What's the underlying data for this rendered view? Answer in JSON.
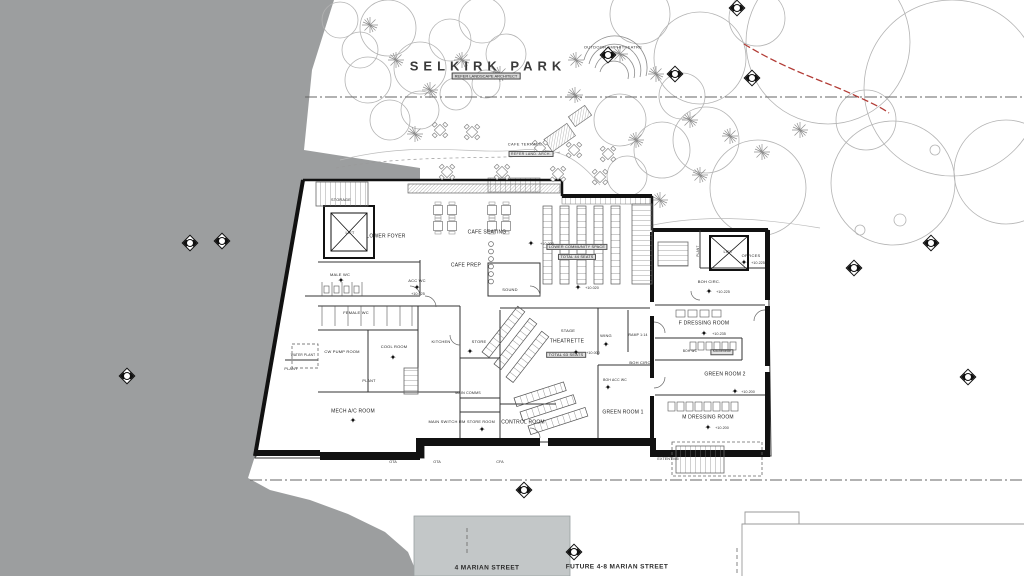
{
  "colors": {
    "terrain": "#9c9e9f",
    "street_block": "#c3c7c8",
    "red_line": "#b23b35",
    "walls": "#111111"
  },
  "title": {
    "name": "SELKIRK PARK",
    "subtitle": "REFER LANDSCAPE ARCHITECT"
  },
  "park": {
    "amphitheatre_label": "OUTDOOR AMPHITHEATRE",
    "cafe_terrace_label": "CAFE TERRACE",
    "cafe_terrace_note": "REFER LAND. ARCH."
  },
  "streets": {
    "building_label": "4 MARIAN STREET",
    "future_label": "FUTURE 4-8 MARIAN STREET"
  },
  "rooms": [
    {
      "id": "storage",
      "label": "STORAGE",
      "x": 341,
      "y": 200,
      "size": 3.8
    },
    {
      "id": "lift-1",
      "label": "LIFT",
      "x": 350,
      "y": 233,
      "size": 4
    },
    {
      "id": "lower-foyer",
      "label": "LOWER FOYER",
      "x": 386,
      "y": 237
    },
    {
      "id": "cafe-seating",
      "label": "CAFE SEATING",
      "x": 487,
      "y": 233
    },
    {
      "id": "cafe-prep",
      "label": "CAFE PREP",
      "x": 466,
      "y": 266
    },
    {
      "id": "male-wc",
      "label": "MALE WC",
      "x": 340,
      "y": 275,
      "size": 4
    },
    {
      "id": "acc-wc",
      "label": "ACC WC",
      "x": 417,
      "y": 281,
      "size": 4
    },
    {
      "id": "sound",
      "label": "SOUND",
      "x": 510,
      "y": 290,
      "size": 4
    },
    {
      "id": "female-wc",
      "label": "FEMALE WC",
      "x": 356,
      "y": 313,
      "size": 4
    },
    {
      "id": "cw-pump-room",
      "label": "CW PUMP ROOM",
      "x": 342,
      "y": 352,
      "size": 4
    },
    {
      "id": "cool-room",
      "label": "COOL ROOM",
      "x": 394,
      "y": 347,
      "size": 4
    },
    {
      "id": "kitchen",
      "label": "KITCHEN",
      "x": 441,
      "y": 342,
      "size": 4
    },
    {
      "id": "store",
      "label": "STORE",
      "x": 479,
      "y": 342,
      "size": 4
    },
    {
      "id": "water-plant",
      "label": "WATER PLANT",
      "x": 303,
      "y": 356,
      "size": 3.2
    },
    {
      "id": "plant-1",
      "label": "PLANT",
      "x": 291,
      "y": 369,
      "size": 3.8
    },
    {
      "id": "plant-2",
      "label": "PLANT",
      "x": 369,
      "y": 381,
      "size": 3.8
    },
    {
      "id": "mech-ac-room",
      "label": "MECH A/C ROOM",
      "x": 353,
      "y": 412
    },
    {
      "id": "main-switch-rm",
      "label": "MAIN SWITCH RM",
      "x": 447,
      "y": 422,
      "size": 4
    },
    {
      "id": "main-comms",
      "label": "MAIN COMMS",
      "x": 468,
      "y": 394,
      "size": 3.6
    },
    {
      "id": "store-room",
      "label": "STORE ROOM",
      "x": 481,
      "y": 422,
      "size": 3.8
    },
    {
      "id": "control-room",
      "label": "CONTROL ROOM",
      "x": 523,
      "y": 423
    },
    {
      "id": "stage",
      "label": "STAGE",
      "x": 568,
      "y": 331,
      "size": 4
    },
    {
      "id": "theatrette",
      "label": "THEATRETTE",
      "x": 567,
      "y": 342
    },
    {
      "id": "theatrette-seats",
      "label": "TOTAL 63 SEATS",
      "x": 566,
      "y": 355,
      "boxed": true,
      "size": 4
    },
    {
      "id": "wing",
      "label": "WING",
      "x": 606,
      "y": 336,
      "size": 4
    },
    {
      "id": "ramp",
      "label": "RAMP 1:14",
      "x": 638,
      "y": 336,
      "size": 3.4
    },
    {
      "id": "boh-circ-1",
      "label": "BOH CIRC",
      "x": 640,
      "y": 363,
      "size": 4
    },
    {
      "id": "boh-acc-wc",
      "label": "BOH ACC WC",
      "x": 615,
      "y": 381,
      "size": 3.4
    },
    {
      "id": "green-room-1",
      "label": "GREEN ROOM 1",
      "x": 623,
      "y": 413
    },
    {
      "id": "community-space",
      "label": "LOWER COMMUNITY SPACE",
      "x": 577,
      "y": 247,
      "boxed": true,
      "size": 3.8
    },
    {
      "id": "community-seats",
      "label": "TOTAL 44 SEATS",
      "x": 577,
      "y": 257,
      "boxed": true,
      "size": 3.8
    },
    {
      "id": "plant-3",
      "label": "PLANT",
      "x": 699,
      "y": 251,
      "size": 3.2,
      "vertical": true
    },
    {
      "id": "lift-2",
      "label": "LIFT",
      "x": 728,
      "y": 252,
      "size": 4
    },
    {
      "id": "offices",
      "label": "OFFICES",
      "x": 751,
      "y": 256,
      "size": 4
    },
    {
      "id": "boh-circ-2",
      "label": "BOH CIRC.",
      "x": 709,
      "y": 282,
      "size": 4
    },
    {
      "id": "f-dressing-room",
      "label": "F DRESSING ROOM",
      "x": 704,
      "y": 324
    },
    {
      "id": "boh-wc",
      "label": "BOH WC",
      "x": 690,
      "y": 352,
      "size": 3.2
    },
    {
      "id": "kitchenette",
      "label": "Kitchenette",
      "x": 722,
      "y": 352,
      "size": 3.2,
      "boxed": true
    },
    {
      "id": "green-room-2",
      "label": "GREEN ROOM 2",
      "x": 725,
      "y": 375
    },
    {
      "id": "m-dressing-room",
      "label": "M DRESSING ROOM",
      "x": 708,
      "y": 418
    }
  ],
  "annotations": [
    {
      "id": "lvl-cafe",
      "text": "+10.000",
      "x": 547,
      "y": 244
    },
    {
      "id": "lvl-accwc",
      "text": "+10.025",
      "x": 418,
      "y": 294
    },
    {
      "id": "lvl-community",
      "text": "+10.020",
      "x": 592,
      "y": 288
    },
    {
      "id": "lvl-theatrette",
      "text": "+10.000",
      "x": 593,
      "y": 353
    },
    {
      "id": "lvl-boh-circ2",
      "text": "+10.225",
      "x": 723,
      "y": 292
    },
    {
      "id": "lvl-offices",
      "text": "+10.225",
      "x": 758,
      "y": 263
    },
    {
      "id": "lvl-f-dressing",
      "text": "+10.235",
      "x": 719,
      "y": 334
    },
    {
      "id": "lvl-green2",
      "text": "+10.200",
      "x": 748,
      "y": 392
    },
    {
      "id": "lvl-m-dressing",
      "text": "+10.200",
      "x": 722,
      "y": 428
    },
    {
      "id": "ota-1",
      "text": "OTA",
      "x": 393,
      "y": 462
    },
    {
      "id": "ota-2",
      "text": "OTA",
      "x": 437,
      "y": 462
    },
    {
      "id": "cfa",
      "text": "CFA",
      "x": 500,
      "y": 462
    },
    {
      "id": "extent",
      "text": "EXTENT M5",
      "x": 668,
      "y": 459
    }
  ],
  "level_stars": [
    {
      "x": 531,
      "y": 244
    },
    {
      "x": 417,
      "y": 288
    },
    {
      "x": 578,
      "y": 288
    },
    {
      "x": 576,
      "y": 353
    },
    {
      "x": 709,
      "y": 292
    },
    {
      "x": 744,
      "y": 263
    },
    {
      "x": 704,
      "y": 334
    },
    {
      "x": 735,
      "y": 392
    },
    {
      "x": 708,
      "y": 428
    },
    {
      "x": 470,
      "y": 352
    },
    {
      "x": 393,
      "y": 358
    },
    {
      "x": 353,
      "y": 421
    },
    {
      "x": 482,
      "y": 430
    },
    {
      "x": 341,
      "y": 281
    },
    {
      "x": 606,
      "y": 345
    },
    {
      "x": 608,
      "y": 388
    }
  ],
  "survey_markers": [
    {
      "x": 190,
      "y": 243
    },
    {
      "x": 222,
      "y": 241
    },
    {
      "x": 127,
      "y": 376
    },
    {
      "x": 608,
      "y": 55
    },
    {
      "x": 675,
      "y": 74
    },
    {
      "x": 737,
      "y": 8
    },
    {
      "x": 752,
      "y": 78
    },
    {
      "x": 854,
      "y": 268
    },
    {
      "x": 931,
      "y": 243
    },
    {
      "x": 968,
      "y": 377
    },
    {
      "x": 524,
      "y": 490
    },
    {
      "x": 574,
      "y": 552
    }
  ]
}
